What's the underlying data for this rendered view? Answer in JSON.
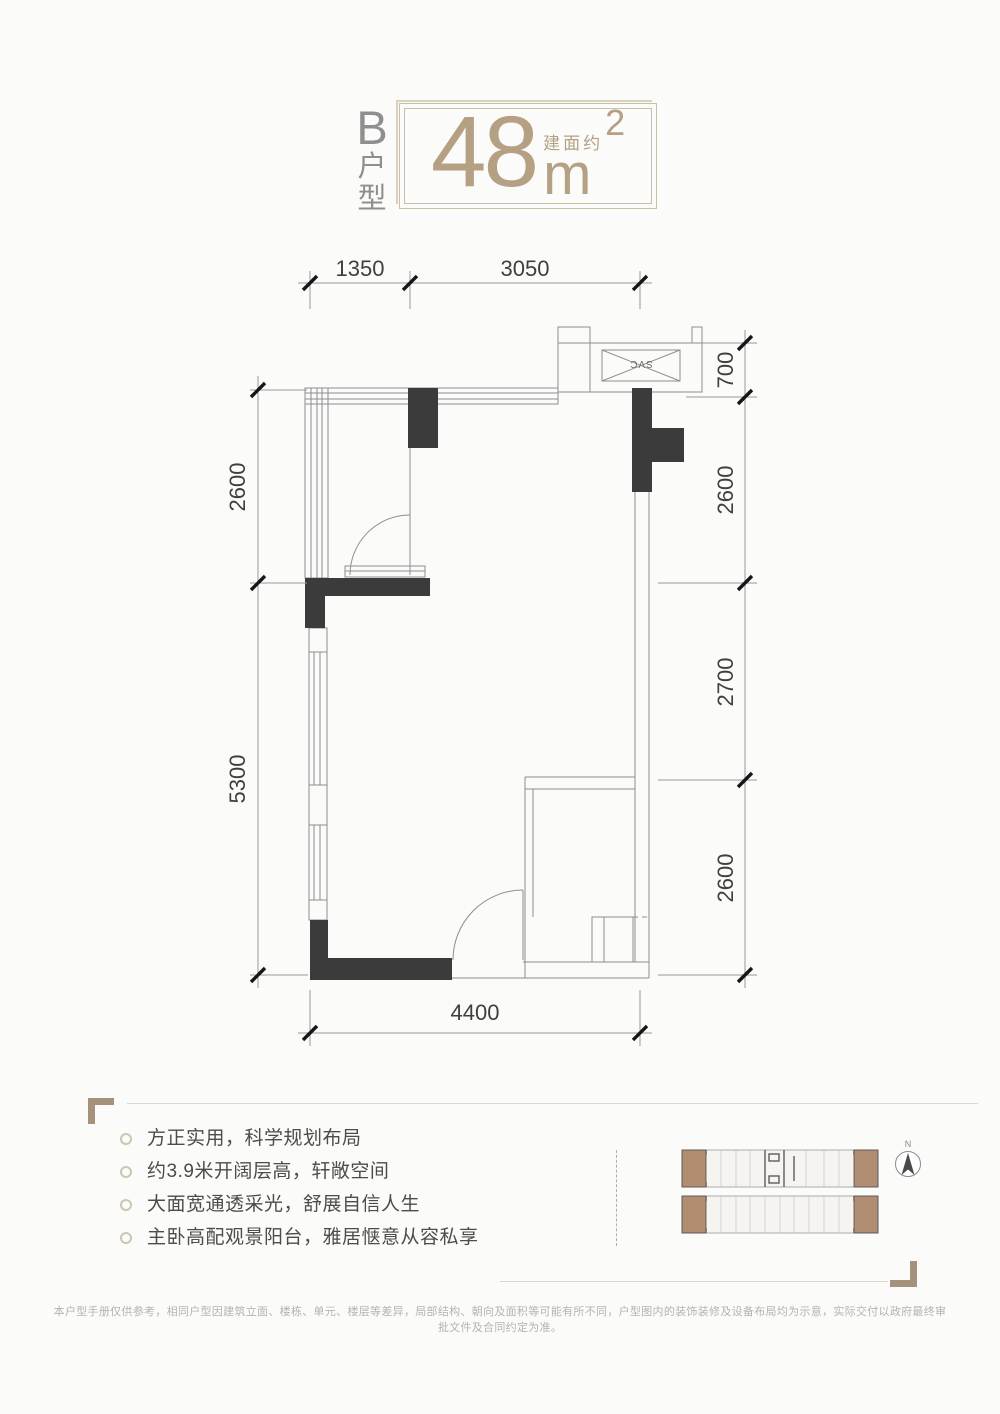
{
  "header": {
    "type_chars": [
      "B",
      "户",
      "型"
    ],
    "area_prefix": "建面约",
    "area_value": "48",
    "area_unit": "m",
    "area_exponent": "2"
  },
  "floorplan": {
    "shaft_label": "SVC",
    "dims": {
      "top": [
        "1350",
        "3050"
      ],
      "right": [
        "700",
        "2600",
        "2700",
        "2600"
      ],
      "left": [
        "2600",
        "5300"
      ],
      "bottom": [
        "4400"
      ]
    }
  },
  "features": {
    "items": [
      "方正实用，科学规划布局",
      "约3.9米开阔层高，轩敞空间",
      "大面宽通透采光，舒展自信人生",
      "主卧高配观景阳台，雅居惬意从容私享"
    ]
  },
  "keyplan": {
    "north_label": "N"
  },
  "disclaimer": "本户型手册仅供参考，相同户型因建筑立面、楼栋、单元、楼层等差异，局部结构、朝向及面积等可能有所不同，户型图内的装饰装修及设备布局均为示意，实际交付以政府最终审批文件及合同约定为准。",
  "colors": {
    "accent_tan": "#b5a084",
    "box_border": "#cbbfa8",
    "wall_dark": "#3b3b3b",
    "keyplan_unit_fill": "#b18e71",
    "feature_text": "#4c4c4c"
  }
}
